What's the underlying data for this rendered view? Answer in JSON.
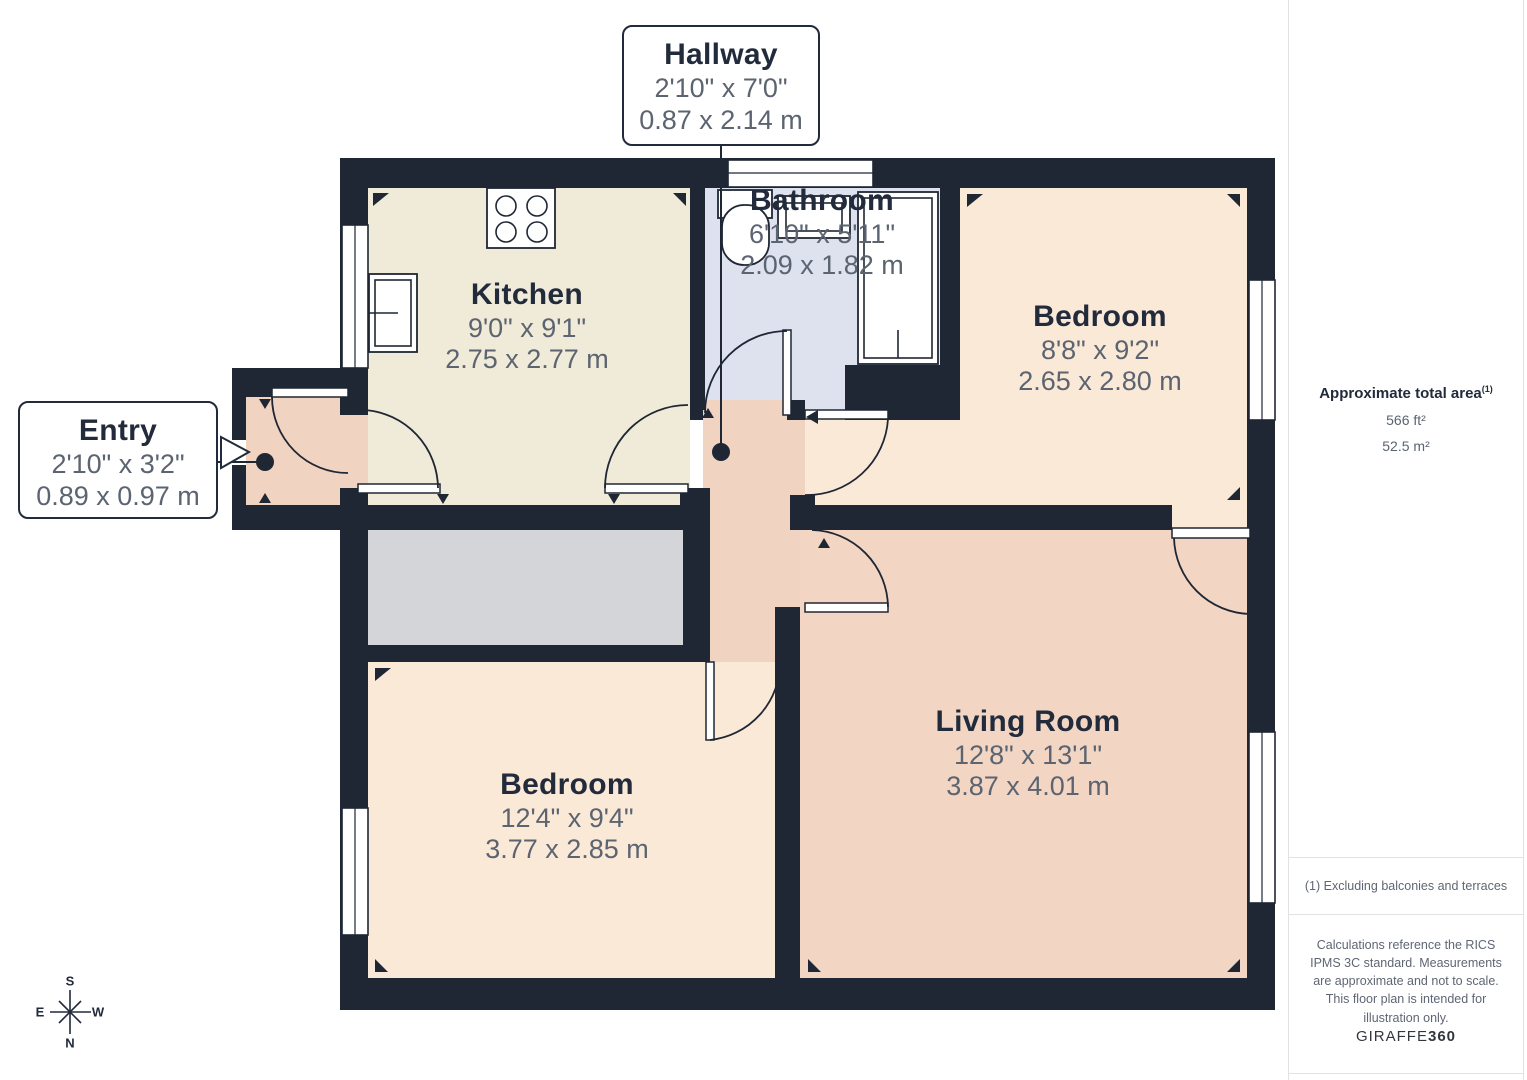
{
  "rooms": [
    {
      "id": "kitchen",
      "name": "Kitchen",
      "imperial": "9'0\" x 9'1\"",
      "metric": "2.75 x 2.77 m"
    },
    {
      "id": "bathroom",
      "name": "Bathroom",
      "imperial": "6'10\" x 5'11\"",
      "metric": "2.09 x 1.82 m"
    },
    {
      "id": "bedroom-top",
      "name": "Bedroom",
      "imperial": "8'8\" x 9'2\"",
      "metric": "2.65 x 2.80 m"
    },
    {
      "id": "living-room",
      "name": "Living Room",
      "imperial": "12'8\" x 13'1\"",
      "metric": "3.87 x 4.01 m"
    },
    {
      "id": "bedroom-bottom",
      "name": "Bedroom",
      "imperial": "12'4\" x 9'4\"",
      "metric": "3.77 x 2.85 m"
    }
  ],
  "callouts": [
    {
      "id": "hallway",
      "name": "Hallway",
      "imperial": "2'10\" x 7'0\"",
      "metric": "0.87 x 2.14 m"
    },
    {
      "id": "entry",
      "name": "Entry",
      "imperial": "2'10\" x 3'2\"",
      "metric": "0.89 x 0.97 m"
    }
  ],
  "sidebar": {
    "area_title": "Approximate total area",
    "area_superscript": "(1)",
    "area_ft": "566 ft²",
    "area_m": "52.5 m²",
    "footnote": "(1) Excluding balconies and terraces",
    "disclaimer": "Calculations reference the RICS IPMS 3C standard. Measurements are approximate and not to scale. This floor plan is intended for illustration only.",
    "brand": {
      "name": "GIRAFFE",
      "suffix": "360"
    }
  },
  "compass": {
    "n": "N",
    "s": "S",
    "e": "E",
    "w": "W"
  },
  "colors": {
    "wall": "#1f2734",
    "ink": "#222b3b",
    "dim": "#5b6470",
    "kitchen": "#f0ead8",
    "bathroom": "#dde2ee",
    "bedroom": "#fbe9d8",
    "living": "#f3d5c3",
    "hall": "#f1d3c1",
    "closet": "#d3d5d8",
    "line": "#e2e2e2"
  }
}
